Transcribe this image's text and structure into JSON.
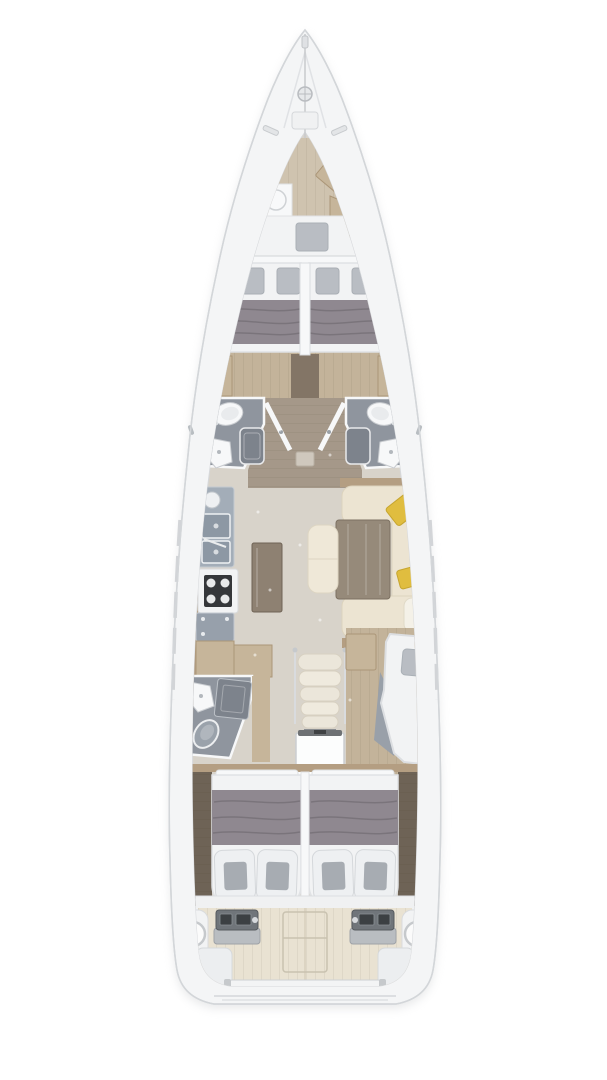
{
  "meta": {
    "type": "sailing-yacht-interior-floor-plan",
    "view": "top-down deck plan",
    "background": "#ffffff"
  },
  "palette": {
    "background": "#ffffff",
    "hull": "#f4f5f6",
    "hull_line": "#d3d6d9",
    "deck_detail": "#c9ccd0",
    "floor": "#d8d3ca",
    "floor_wood": "#c3b39a",
    "wood_light": "#cfc3af",
    "wood_tan": "#c6b59a",
    "wood_trim": "#b49e82",
    "wood_dark": "#6e6356",
    "corridor_wood": "#a59889",
    "wall": "#f7f8f9",
    "mattress": "#f2f3f4",
    "mattress_line": "#dfe1e4",
    "blanket": "#8f8890",
    "pillow_gray": "#b9bdc3",
    "pillow_white": "#eef0f2",
    "pillow_pad": "#a7acb2",
    "bath_floor": "#8f959e",
    "shower": "#7d838c",
    "fixture": "#f7f8f9",
    "counter": "#a3adb8",
    "counter_low": "#97a0ab",
    "basin": "#8d98a4",
    "stove": "#35373a",
    "sofa": "#ece4d2",
    "sofa_light": "#f3eee1",
    "sofa_edge": "#dcd3bd",
    "accent_pillow": "#e0bd3f",
    "table": "#968a7a",
    "island": "#8e8172",
    "chaise": "#efe8d8",
    "steps": "#ebe6da",
    "steps_alt": "#efeade",
    "teak": "#e9e2d2",
    "seat": "#eceef0",
    "console": "#70757a",
    "screen": "#3c4043",
    "metal": "#c6c9cc"
  },
  "areas": [
    "bow-deck-with-windlass",
    "skipper-cabin",
    "forward-cabin-port",
    "forward-cabin-starboard",
    "head-port",
    "head-starboard",
    "galley",
    "salon-with-u-sofa-and-table",
    "day-head",
    "companionway-stairs",
    "single-berth-cabin",
    "aft-cabin-port",
    "aft-cabin-starboard",
    "cockpit-with-twin-helms"
  ]
}
